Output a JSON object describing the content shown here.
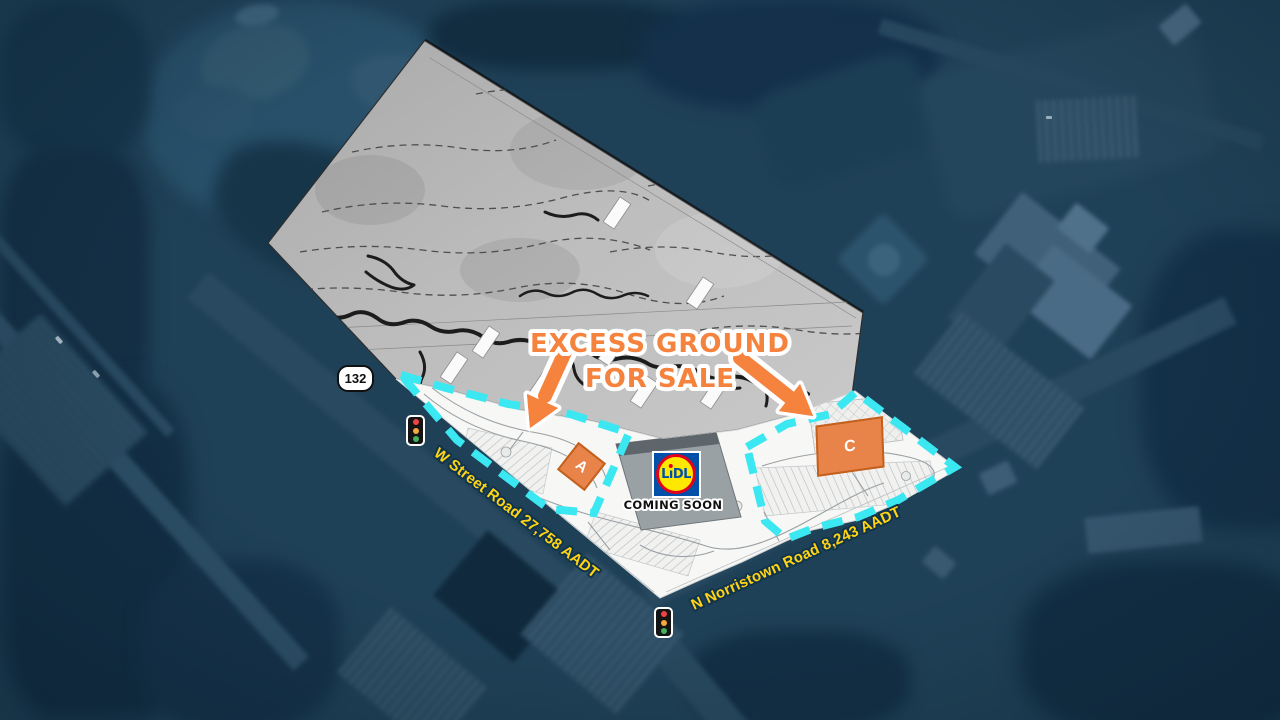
{
  "callout": {
    "line1": "EXCESS GROUND",
    "line2": "FOR SALE"
  },
  "roads": {
    "route_shield": "132",
    "w_street_label": "W Street Road 27,758 AADT",
    "norristown_label": "N Norristown Road 8,243 AADT"
  },
  "store": {
    "brand_l": "L",
    "brand_i": "ı",
    "brand_dl": "DL",
    "brand_full": "LiDL",
    "coming_soon": "COMING SOON"
  },
  "parcels": [
    {
      "label": "A"
    },
    {
      "label": "C"
    }
  ],
  "icons": {
    "traffic_light": "traffic-light-icon",
    "route_shield": "route-132-shield",
    "callout_arrow": "orange-arrow-icon"
  },
  "colors": {
    "accent_orange": "#F5823D",
    "boundary_cyan": "#3BE8F2",
    "road_label_yellow": "#FFD414",
    "lidl_blue": "#0050AA",
    "lidl_yellow": "#FFE800",
    "lidl_red": "#E3001B",
    "aerial_navy": "#1F4157"
  }
}
